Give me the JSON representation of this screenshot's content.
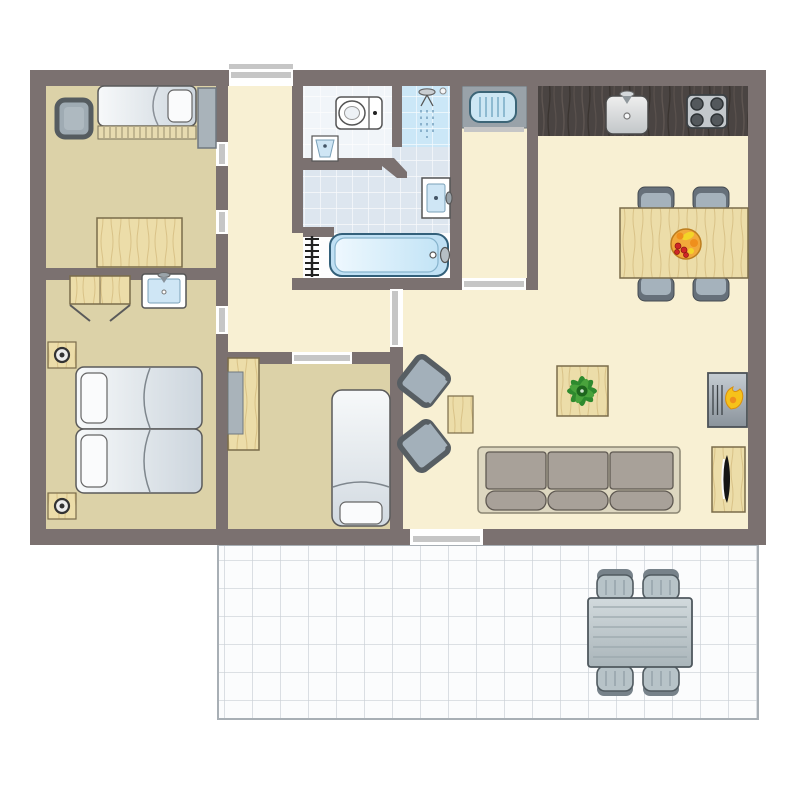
{
  "plan": {
    "type": "floor-plan",
    "rooms": [
      {
        "id": "bedroom-1",
        "label": "bedroom-top-left",
        "furniture": [
          "single-bed",
          "armchair",
          "wardrobe",
          "desk"
        ]
      },
      {
        "id": "bedroom-2",
        "label": "bedroom-bottom-left",
        "furniture": [
          "double-bed",
          "nightstand-lamp",
          "nightstand-lamp",
          "wardrobe-open-doors",
          "washbasin"
        ]
      },
      {
        "id": "bedroom-3",
        "label": "bedroom-middle",
        "furniture": [
          "single-bed",
          "desk",
          "desk-chair"
        ]
      },
      {
        "id": "hall",
        "label": "entrance-hall",
        "furniture": [
          "front-door"
        ]
      },
      {
        "id": "bathroom",
        "label": "bathroom",
        "furniture": [
          "toilet",
          "corner-basin",
          "shower",
          "washbasin",
          "bathtub",
          "towel-radiator"
        ]
      },
      {
        "id": "storage",
        "label": "storage-closet",
        "furniture": [
          "boiler"
        ]
      },
      {
        "id": "kitchen-living",
        "label": "kitchen-living-dining",
        "furniture": [
          "kitchen-counter",
          "kitchen-sink",
          "hob-4-burners",
          "dining-table",
          "dining-chair",
          "dining-chair",
          "dining-chair",
          "dining-chair",
          "fruit-bowl",
          "lounge-armchair",
          "lounge-armchair",
          "side-table",
          "coffee-table",
          "plant",
          "sofa-3-seats",
          "fireplace",
          "tv-cabinet"
        ]
      },
      {
        "id": "terrace",
        "label": "terrace",
        "furniture": [
          "garden-table",
          "garden-chair",
          "garden-chair",
          "garden-chair",
          "garden-chair"
        ]
      }
    ]
  },
  "colors": {
    "wall": "#7b7170",
    "floor_bedroom": "#dcd2a8",
    "floor_living": "#f8f0d3",
    "bathroom_tile": "#dde6ef",
    "toilet_tile": "#f1f5f9",
    "shower_tile": "#cbe7f7",
    "tub_strip": "#fdfdfe",
    "door_line": "#c6c6c6",
    "cushion": "#a8a199",
    "sofa_frame": "#ddd7c0",
    "chair_upholstery": "#a3b0ba",
    "chair_border": "#575e63",
    "appliance_blue": "#cde7f4",
    "counter_gray": "#99a2a9",
    "terrace_border": "#a8afb5",
    "plant_green": "#2e8a2e",
    "flame_yellow": "#f6c21a",
    "flame_orange": "#ef8f1c",
    "fruit_bowl_orange": "#f2a93b",
    "wood_light": "#ecdda9",
    "wood_dark_counter": "#4a4442"
  }
}
